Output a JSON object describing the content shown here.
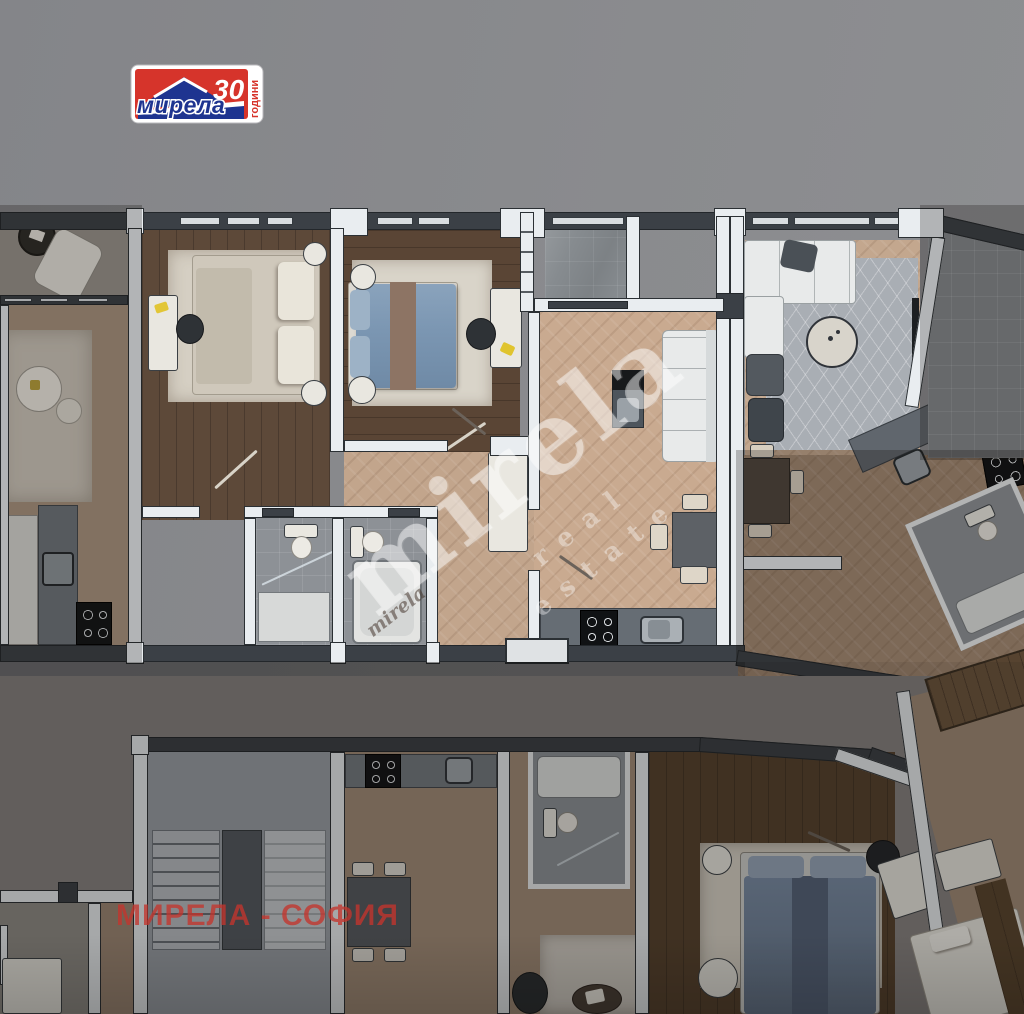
{
  "scene_type": "apartment-floor-plan-3d-render",
  "logo": {
    "brand": "мирела",
    "number": "30",
    "word": "години",
    "red": "#d6342b",
    "blue": "#1e3490"
  },
  "watermarks": {
    "primary": "mirela",
    "secondary": "real estate",
    "tertiary": "mirela",
    "city_line": "МИРЕЛА - СОФИЯ",
    "city_color": "#c0392f"
  },
  "colors": {
    "background": "#88898c",
    "wall_dark": "#3b4046",
    "wall_light": "#e9edf0",
    "wood_dark": "#5c4737",
    "floor_beige": "#c9aa90",
    "floor_beige_dim": "#a28872",
    "tile_gray": "#8d9196",
    "rug_light": "#d6d0c4",
    "rug_gray": "#a9aeb4",
    "bed_blue": "#7b96b2",
    "accent_yellow": "#e2c636"
  }
}
